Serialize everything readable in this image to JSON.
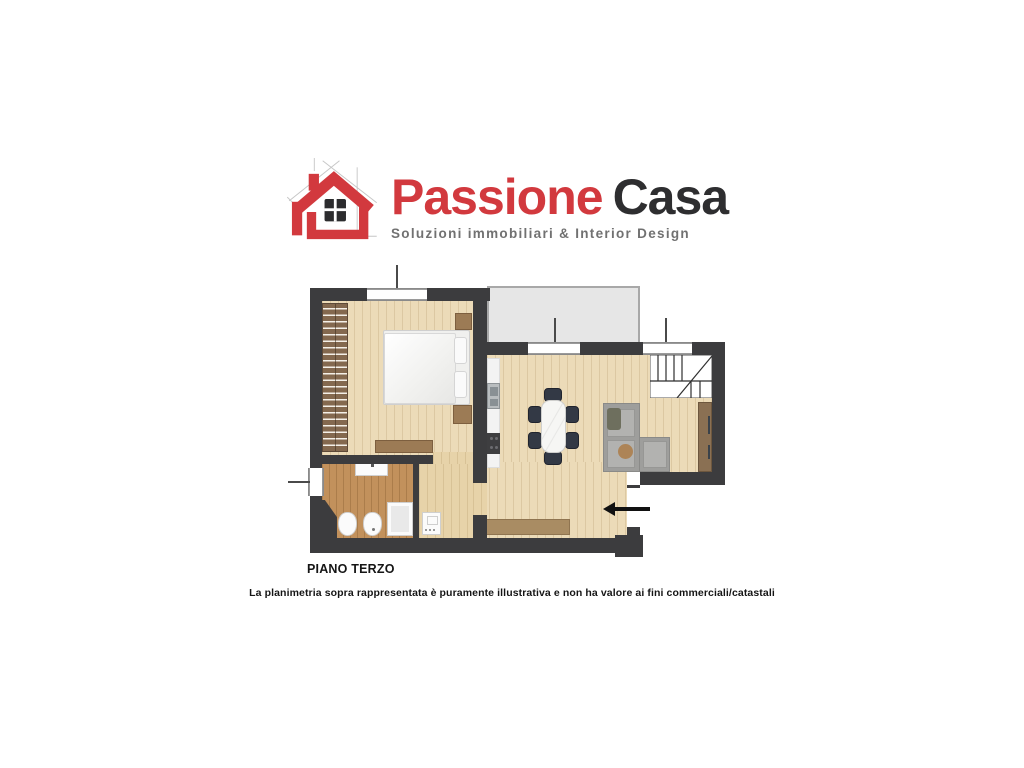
{
  "header": {
    "brand_first": "Passione",
    "brand_second": "Casa",
    "tagline": "Soluzioni immobiliari & Interior Design"
  },
  "plan": {
    "floor_label": "PIANO TERZO",
    "disclaimer": "La planimetria sopra rappresentata è puramente illustrativa e non ha valore ai fini commerciali/catastali"
  },
  "colors": {
    "brand_red": "#d2393e",
    "brand_dark": "#2e2e30",
    "tagline_gray": "#717171",
    "wall": "#3c3c3e",
    "floor_light_wood": "#ecdbb8",
    "floor_bathroom_wood": "#c2915c",
    "balcony_gray": "#e6e6e6",
    "sofa_gray": "#9e9e9c",
    "furniture_brown": "#9c7b55"
  }
}
